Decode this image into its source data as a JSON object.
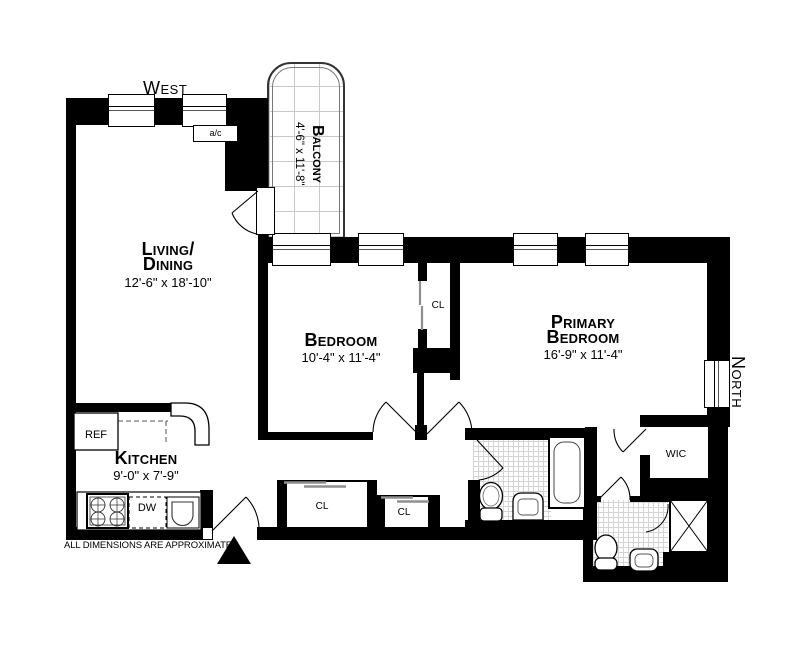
{
  "note": "ALL DIMENSIONS ARE APPROXIMATE",
  "compass": {
    "west": "West",
    "north": "North"
  },
  "rooms": {
    "living_dining": {
      "name_line1": "Living/",
      "name_line2": "Dining",
      "dimensions": "12'-6\" x 18'-10\""
    },
    "balcony": {
      "name": "Balcony",
      "dimensions": "4'-6\" x 11'-8\""
    },
    "bedroom": {
      "name": "Bedroom",
      "dimensions": "10'-4\" x 11'-4\""
    },
    "primary_bedroom": {
      "name_line1": "Primary",
      "name_line2": "Bedroom",
      "dimensions": "16'-9\" x 11'-4\""
    },
    "kitchen": {
      "name": "Kitchen",
      "dimensions": "9'-0\" x 7'-9\""
    },
    "walk_in_closet": "WIC",
    "closet_bedroom": "CL",
    "closet_hall_1": "CL",
    "closet_hall_2": "CL"
  },
  "appliances": {
    "refrigerator": "REF",
    "dishwasher": "DW",
    "air_conditioner": "a/c"
  },
  "colors": {
    "wall": "#000000",
    "background": "#ffffff",
    "tile_line": "#d4d4d4",
    "fixture_line": "#444444"
  }
}
